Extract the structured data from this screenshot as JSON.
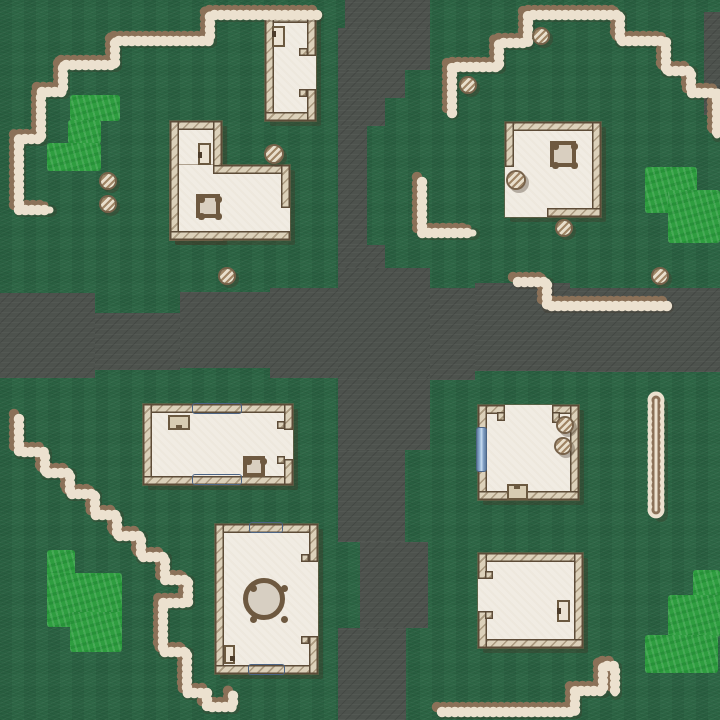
{
  "scene": {
    "width": 720,
    "height": 720,
    "kind": "top-down-village-map"
  },
  "palette": {
    "grass": "#2e6746",
    "road": "#4d524d",
    "patch_green": "#2f9e40",
    "fence_brown": "#8b7158",
    "fence_cream": "#ece1cf",
    "fence_shadow": "rgba(66,52,36,0.28)",
    "wall_fill": "#dcd1ba",
    "wall_outline": "#5d4c38",
    "floor": "#f1ece3",
    "door_fill": "#ece3d3",
    "table_wood": "#6e5940",
    "window_blue": "#8fb0d4",
    "rock_fill": "#e9dfcc",
    "shadow": "rgba(66,52,36,0.33)"
  },
  "roads": [
    [
      345,
      0,
      85,
      28
    ],
    [
      338,
      28,
      92,
      42
    ],
    [
      338,
      70,
      67,
      28
    ],
    [
      338,
      98,
      47,
      28
    ],
    [
      338,
      126,
      29,
      119
    ],
    [
      338,
      245,
      47,
      23
    ],
    [
      338,
      268,
      92,
      110
    ],
    [
      0,
      293,
      95,
      85
    ],
    [
      95,
      313,
      85,
      57
    ],
    [
      180,
      292,
      90,
      76
    ],
    [
      270,
      288,
      68,
      90
    ],
    [
      430,
      288,
      45,
      92
    ],
    [
      475,
      283,
      95,
      88
    ],
    [
      570,
      288,
      150,
      84
    ],
    [
      704,
      12,
      16,
      103
    ],
    [
      338,
      378,
      92,
      72
    ],
    [
      338,
      450,
      67,
      92
    ],
    [
      360,
      542,
      68,
      86
    ],
    [
      338,
      628,
      68,
      92
    ]
  ],
  "patches": [
    {
      "name": "bush-patch-nw",
      "rects": [
        [
          70,
          95,
          50,
          26
        ],
        [
          68,
          120,
          33,
          24
        ],
        [
          47,
          143,
          54,
          28
        ]
      ]
    },
    {
      "name": "bush-patch-ne",
      "rects": [
        [
          645,
          167,
          52,
          46
        ],
        [
          668,
          190,
          52,
          53
        ]
      ]
    },
    {
      "name": "bush-patch-sw",
      "rects": [
        [
          47,
          550,
          28,
          77
        ],
        [
          47,
          573,
          75,
          54
        ],
        [
          70,
          612,
          52,
          40
        ]
      ]
    },
    {
      "name": "bush-patch-se",
      "rects": [
        [
          693,
          570,
          27,
          33
        ],
        [
          668,
          595,
          52,
          42
        ],
        [
          645,
          635,
          73,
          38
        ]
      ]
    }
  ],
  "fences": [
    {
      "name": "fence-nw-staircase",
      "style": "standard",
      "points": [
        [
          312,
          10
        ],
        [
          205,
          10
        ],
        [
          205,
          36
        ],
        [
          110,
          36
        ],
        [
          110,
          60
        ],
        [
          58,
          60
        ],
        [
          58,
          87
        ],
        [
          36,
          87
        ],
        [
          36,
          134
        ],
        [
          14,
          134
        ],
        [
          14,
          205
        ],
        [
          45,
          205
        ]
      ]
    },
    {
      "name": "fence-ne-staircase",
      "style": "standard",
      "points": [
        [
          447,
          108
        ],
        [
          447,
          62
        ],
        [
          494,
          62
        ],
        [
          494,
          38
        ],
        [
          523,
          38
        ],
        [
          523,
          10
        ],
        [
          615,
          10
        ],
        [
          615,
          36
        ],
        [
          661,
          36
        ],
        [
          661,
          66
        ],
        [
          686,
          66
        ],
        [
          686,
          88
        ],
        [
          712,
          88
        ],
        [
          712,
          130
        ]
      ]
    },
    {
      "name": "fence-ne-corner",
      "style": "standard",
      "points": [
        [
          417,
          177
        ],
        [
          417,
          228
        ],
        [
          468,
          228
        ]
      ]
    },
    {
      "name": "fence-ne-zigzag",
      "style": "standard",
      "points": [
        [
          513,
          277
        ],
        [
          542,
          277
        ],
        [
          542,
          301
        ],
        [
          662,
          301
        ]
      ]
    },
    {
      "name": "fence-sw-staircase",
      "style": "standard",
      "points": [
        [
          14,
          414
        ],
        [
          14,
          447
        ],
        [
          40,
          447
        ],
        [
          40,
          468
        ],
        [
          65,
          468
        ],
        [
          65,
          489
        ],
        [
          90,
          489
        ],
        [
          90,
          510
        ],
        [
          112,
          510
        ],
        [
          112,
          531
        ],
        [
          136,
          531
        ],
        [
          136,
          552
        ],
        [
          160,
          552
        ],
        [
          160,
          575
        ],
        [
          183,
          575
        ],
        [
          183,
          598
        ],
        [
          158,
          598
        ],
        [
          158,
          647
        ],
        [
          182,
          647
        ],
        [
          182,
          688
        ],
        [
          202,
          688
        ],
        [
          202,
          702
        ],
        [
          228,
          702
        ],
        [
          228,
          690
        ]
      ]
    },
    {
      "name": "fence-se-hairpin",
      "style": "hairpin",
      "points": [
        [
          656,
          400
        ],
        [
          656,
          510
        ]
      ]
    },
    {
      "name": "fence-se-zigzag",
      "style": "standard",
      "points": [
        [
          437,
          707
        ],
        [
          570,
          707
        ],
        [
          570,
          686
        ],
        [
          598,
          686
        ],
        [
          598,
          661
        ],
        [
          610,
          661
        ],
        [
          610,
          688
        ]
      ]
    }
  ],
  "rocks": [
    [
      108,
      181,
      7
    ],
    [
      108,
      204,
      7
    ],
    [
      274,
      154,
      8
    ],
    [
      227,
      276,
      7
    ],
    [
      541,
      36,
      7
    ],
    [
      468,
      85,
      7
    ],
    [
      516,
      180,
      8
    ],
    [
      564,
      228,
      7
    ],
    [
      660,
      276,
      7
    ],
    [
      565,
      425,
      7
    ],
    [
      563,
      446,
      7
    ]
  ],
  "buildings": [
    {
      "name": "house-nw-tall",
      "floors": [
        [
          265,
          14,
          51,
          107
        ]
      ],
      "walls": [
        [
          265,
          14,
          51,
          9
        ],
        [
          265,
          14,
          9,
          107
        ],
        [
          265,
          112,
          51,
          9
        ],
        [
          307,
          14,
          9,
          42
        ],
        [
          299,
          48,
          9,
          8
        ],
        [
          307,
          89,
          9,
          32
        ],
        [
          299,
          89,
          8,
          8
        ]
      ],
      "doors": [
        {
          "rect": [
            272,
            26,
            13,
            21
          ],
          "handle": [
            272,
            31,
            4,
            6
          ]
        }
      ],
      "tables_square": [],
      "tables_round": [],
      "windows": [],
      "boxes": []
    },
    {
      "name": "house-nw-lshape",
      "floors": [
        [
          170,
          121,
          52,
          119
        ],
        [
          170,
          165,
          120,
          75
        ]
      ],
      "walls": [
        [
          170,
          121,
          52,
          9
        ],
        [
          170,
          121,
          9,
          119
        ],
        [
          170,
          231,
          120,
          9
        ],
        [
          213,
          121,
          9,
          53
        ],
        [
          213,
          165,
          77,
          9
        ],
        [
          281,
          165,
          9,
          43
        ]
      ],
      "doors": [
        {
          "rect": [
            198,
            143,
            13,
            22
          ],
          "handle": [
            198,
            152,
            4,
            6
          ]
        }
      ],
      "tables_square": [
        {
          "rect": [
            196,
            194,
            24,
            24
          ],
          "knobs": 4
        }
      ],
      "tables_round": [],
      "windows": [],
      "boxes": []
    },
    {
      "name": "house-ne-square",
      "floors": [
        [
          505,
          122,
          96,
          95
        ]
      ],
      "walls": [
        [
          505,
          122,
          96,
          9
        ],
        [
          592,
          122,
          9,
          95
        ],
        [
          505,
          122,
          9,
          45
        ],
        [
          547,
          208,
          54,
          9
        ]
      ],
      "doors": [],
      "tables_square": [
        {
          "rect": [
            550,
            141,
            26,
            26
          ],
          "knobs": 4
        }
      ],
      "tables_round": [],
      "windows": [],
      "boxes": []
    },
    {
      "name": "house-sw-wide",
      "floors": [
        [
          143,
          404,
          150,
          81
        ]
      ],
      "walls": [
        [
          143,
          404,
          150,
          9
        ],
        [
          143,
          404,
          9,
          81
        ],
        [
          143,
          476,
          150,
          9
        ],
        [
          284,
          404,
          9,
          26
        ],
        [
          277,
          421,
          8,
          8
        ],
        [
          284,
          459,
          9,
          26
        ],
        [
          277,
          456,
          8,
          8
        ]
      ],
      "doors": [],
      "tables_square": [
        {
          "rect": [
            243,
            456,
            22,
            21
          ],
          "knobs": 2
        }
      ],
      "tables_round": [],
      "windows": [
        {
          "rect": [
            192,
            403,
            48,
            9
          ],
          "dir": "h"
        },
        {
          "rect": [
            192,
            474,
            48,
            9
          ],
          "dir": "h"
        }
      ],
      "boxes": [
        {
          "rect": [
            168,
            415,
            22,
            15
          ],
          "notch": [
            176,
            425,
            6,
            5
          ]
        }
      ]
    },
    {
      "name": "house-sw-hall",
      "floors": [
        [
          215,
          524,
          103,
          150
        ]
      ],
      "walls": [
        [
          215,
          524,
          103,
          9
        ],
        [
          215,
          524,
          9,
          150
        ],
        [
          215,
          665,
          103,
          9
        ],
        [
          309,
          524,
          9,
          38
        ],
        [
          301,
          554,
          8,
          8
        ],
        [
          309,
          636,
          9,
          38
        ],
        [
          301,
          636,
          8,
          8
        ]
      ],
      "doors": [
        {
          "rect": [
            224,
            645,
            11,
            19
          ],
          "handle": [
            230,
            656,
            5,
            5
          ]
        }
      ],
      "tables_square": [],
      "tables_round": [
        {
          "cx": 264,
          "cy": 599,
          "r": 21
        }
      ],
      "windows": [
        {
          "rect": [
            249,
            522,
            32,
            9
          ],
          "dir": "h"
        },
        {
          "rect": [
            248,
            664,
            35,
            9
          ],
          "dir": "h"
        }
      ],
      "boxes": []
    },
    {
      "name": "house-se-upper",
      "floors": [
        [
          478,
          405,
          101,
          95
        ]
      ],
      "walls": [
        [
          478,
          405,
          27,
          9
        ],
        [
          497,
          412,
          8,
          9
        ],
        [
          552,
          405,
          27,
          9
        ],
        [
          552,
          412,
          8,
          11
        ],
        [
          478,
          405,
          9,
          95
        ],
        [
          570,
          405,
          9,
          95
        ],
        [
          478,
          491,
          101,
          9
        ]
      ],
      "doors": [],
      "tables_square": [],
      "tables_round": [],
      "windows": [
        {
          "rect": [
            476,
            427,
            9,
            43
          ],
          "dir": "v"
        }
      ],
      "boxes": [
        {
          "rect": [
            507,
            484,
            21,
            16
          ],
          "notch": [
            514,
            484,
            6,
            5
          ]
        }
      ]
    },
    {
      "name": "house-se-lower",
      "floors": [
        [
          478,
          553,
          105,
          95
        ]
      ],
      "walls": [
        [
          478,
          553,
          105,
          9
        ],
        [
          574,
          553,
          9,
          95
        ],
        [
          478,
          639,
          105,
          9
        ],
        [
          478,
          553,
          9,
          26
        ],
        [
          485,
          571,
          8,
          8
        ],
        [
          478,
          611,
          9,
          37
        ],
        [
          485,
          611,
          8,
          8
        ]
      ],
      "doors": [
        {
          "rect": [
            557,
            600,
            13,
            22
          ],
          "handle": [
            557,
            608,
            4,
            6
          ]
        }
      ],
      "tables_square": [],
      "tables_round": [],
      "windows": [],
      "boxes": []
    }
  ]
}
